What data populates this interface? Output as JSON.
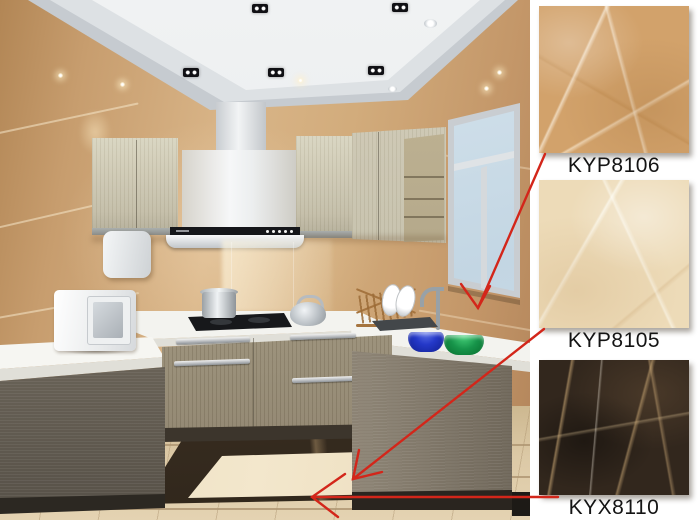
{
  "panel": {
    "products": [
      {
        "code": "KYP8106",
        "swatch_color": "#d2a26b",
        "arrow_target": "kitchen-wall-tiles"
      },
      {
        "code": "KYP8105",
        "swatch_color": "#eddbb8",
        "arrow_target": "kitchen-floor-field-tiles"
      },
      {
        "code": "KYX8110",
        "swatch_color": "#32271d",
        "arrow_target": "kitchen-floor-border-inlay"
      }
    ]
  },
  "palette": {
    "arrow_red": "#d3261a",
    "label_text": "#141414",
    "background": "#ffffff",
    "wall_tile": "#cda378",
    "ceiling": "#e9ebed",
    "cabinet_upper": "#cfcab5",
    "cabinet_base": "#9a9080",
    "countertop": "#f3f3ef",
    "floor_tile": "#d9c6a3",
    "floor_inset": "#ecdcbd",
    "floor_border": "#46372a",
    "window_sky": "#cfe0ea"
  }
}
